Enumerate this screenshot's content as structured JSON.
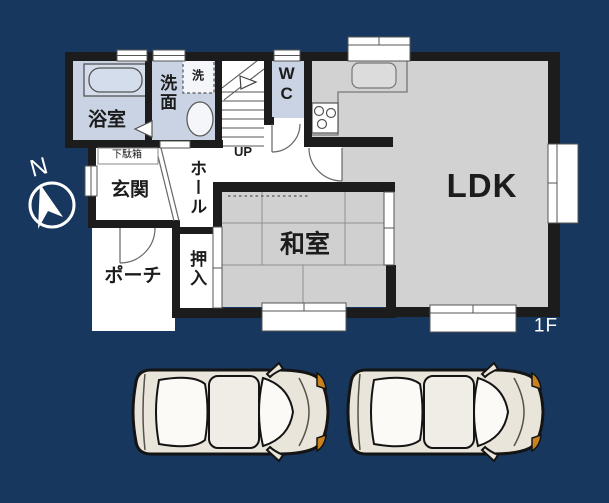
{
  "title": "1F floor plan with two parked cars",
  "floor": {
    "label": "1F"
  },
  "compass": {
    "label": "N"
  },
  "rooms": {
    "bathroom": {
      "label": "浴室"
    },
    "washroom": {
      "label": "洗面"
    },
    "washer": {
      "label": "洗"
    },
    "wc": {
      "label": "WC"
    },
    "stairs": {
      "label": "UP"
    },
    "shoe_cabinet": {
      "label": "下駄箱"
    },
    "entrance": {
      "label": "玄関"
    },
    "hall": {
      "label": "ホール"
    },
    "japanese_room": {
      "label": "和室"
    },
    "closet": {
      "label": "押入"
    },
    "porch": {
      "label": "ポーチ"
    },
    "ldk": {
      "label": "LDK"
    }
  },
  "parking": {
    "car_count": 2,
    "car_style": "top-view sedan"
  },
  "colors": {
    "background": "#17375e",
    "wall": "#1c1c1c",
    "room_gray": "#d2d2d2",
    "room_blue": "#c9d3e3",
    "room_white": "#ffffff",
    "thin_line": "#6f6f6f",
    "car_body": "#eae5da",
    "car_accent": "#c9821f",
    "floor_label_color": "#ffffff"
  }
}
